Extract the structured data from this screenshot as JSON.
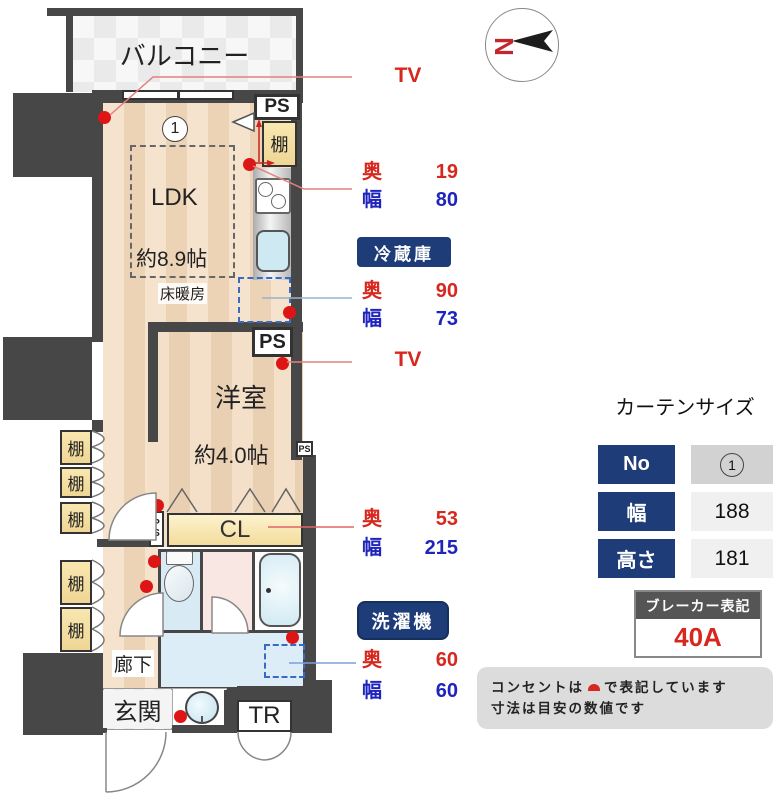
{
  "plan": {
    "balcony": "バルコニー",
    "unit_no": "1",
    "ldk": "LDK",
    "ldk_size": "約8.9帖",
    "floor_heating": "床暖房",
    "western_room": "洋室",
    "western_size": "約4.0帖",
    "closet": "CL",
    "corridor": "廊下",
    "entrance": "玄関",
    "trunk_room": "TR",
    "shelf": "棚",
    "ps": "PS",
    "ps_small": "PS",
    "ps_vertical": {
      "p": "P",
      "s": "S"
    }
  },
  "annotations": {
    "tv": "TV",
    "depth_label": "奥",
    "width_label": "幅",
    "kitchen_shelf": {
      "depth": "19",
      "width": "80"
    },
    "fridge": {
      "title": "冷蔵庫",
      "depth": "90",
      "width": "73"
    },
    "closet": {
      "depth": "53",
      "width": "215"
    },
    "washer": {
      "title": "洗濯機",
      "depth": "60",
      "width": "60"
    }
  },
  "compass": {
    "north": "N"
  },
  "curtain": {
    "title": "カーテンサイズ",
    "no_label": "No",
    "no_value": "1",
    "width_label": "幅",
    "width_value": "188",
    "height_label": "高さ",
    "height_value": "181"
  },
  "breaker": {
    "title": "ブレーカー表記",
    "value": "40A"
  },
  "note": {
    "line1_pre": "コンセントは",
    "line1_post": "で表記しています",
    "line2": "寸法は目安の数値です"
  },
  "colors": {
    "wall": "#474747",
    "accent_red": "#d6281e",
    "accent_blue": "#1f24bd",
    "badge_navy": "#1e3c78",
    "outlet_red": "#dd1515",
    "dashed_blue": "#3a6bc4"
  }
}
